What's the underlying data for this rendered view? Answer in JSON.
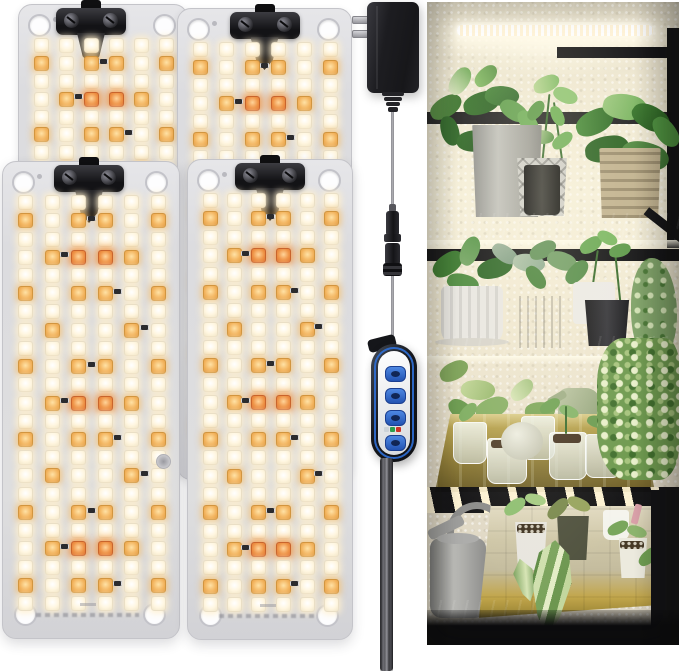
{
  "image": {
    "kind": "product-photo",
    "subject": "4-pack LED grow light panels with power adapter, inline connector, 4-button dimmer controller, and plant shelf lifestyle photo",
    "width": 679,
    "height": 671,
    "visible_text": ""
  },
  "colors": {
    "background": "#ffffff",
    "panel_body": "#dcdcdf",
    "led_warm_white": "#fff6e0",
    "led_amber": "#f3b45e",
    "led_deep_orange": "#ef9447",
    "clamp_black": "#141417",
    "adapter_black": "#1d1d21",
    "cable_gray": "#9a9a9f",
    "controller_blue": "#2e66c8",
    "controller_face": "#eceef0",
    "photo_wall": "#f1ead5",
    "photo_shelf": "#141416",
    "tray_gold": "#b19c48",
    "tray_beige": "#cfc7a8"
  },
  "panels": {
    "count": 4,
    "columns": 6,
    "rows": 23,
    "legend": {
      "w": "warm-white LED",
      "a": "amber LED",
      "o": "deep-orange LED"
    },
    "row_pattern": [
      [
        "w",
        "w",
        "w",
        "w",
        "w",
        "w"
      ],
      [
        "a",
        "w",
        "a",
        "a",
        "w",
        "a"
      ],
      [
        "w",
        "w",
        "w",
        "w",
        "w",
        "w"
      ],
      [
        "w",
        "a",
        "o",
        "o",
        "a",
        "w"
      ],
      [
        "w",
        "w",
        "w",
        "w",
        "w",
        "w"
      ],
      [
        "a",
        "w",
        "a",
        "a",
        "w",
        "a"
      ],
      [
        "w",
        "w",
        "w",
        "w",
        "w",
        "w"
      ],
      [
        "w",
        "a",
        "w",
        "w",
        "a",
        "w"
      ]
    ],
    "instances": [
      {
        "id": "grow-panel-back-left",
        "x": 18,
        "y": 4,
        "w": 168,
        "h": 468,
        "layer": "back",
        "clamp_dx": -12,
        "socket": false
      },
      {
        "id": "grow-panel-back-right",
        "x": 177,
        "y": 8,
        "w": 173,
        "h": 470,
        "layer": "back",
        "clamp_dx": 0,
        "socket": false
      },
      {
        "id": "grow-panel-front-left",
        "x": 2,
        "y": 161,
        "w": 176,
        "h": 476,
        "layer": "front",
        "clamp_dx": -2,
        "socket": true
      },
      {
        "id": "grow-panel-front-right",
        "x": 187,
        "y": 159,
        "w": 164,
        "h": 479,
        "layer": "front",
        "clamp_dx": 0,
        "socket": false
      }
    ]
  },
  "power_chain": {
    "adapter": "black US two-prong wall adapter",
    "inline_connector": "DC barrel plug and jack pair",
    "controller": {
      "shape": "pill remote with white face and blue trim",
      "buttons": [
        {
          "name": "button-1"
        },
        {
          "name": "button-2"
        },
        {
          "name": "button-3"
        },
        {
          "name": "button-4"
        }
      ],
      "indicator_lights": [
        "#cdd3d8",
        "#2f9e4e",
        "#cc3327",
        "#dfe3e6"
      ]
    }
  },
  "photo_scene": {
    "shelves": 4,
    "contents": [
      "LED light bar glowing under top shelf",
      "three pothos plants in gray, black and ribbed tan pots",
      "small potted plants: fluted white pot, gray pot, black pot, trailing vine",
      "gold seed tray with clear cups, seedlings and sage-green watering can",
      "variegated plant mass on right",
      "gray watering can and beige seedling tray on bottom shelf"
    ]
  }
}
